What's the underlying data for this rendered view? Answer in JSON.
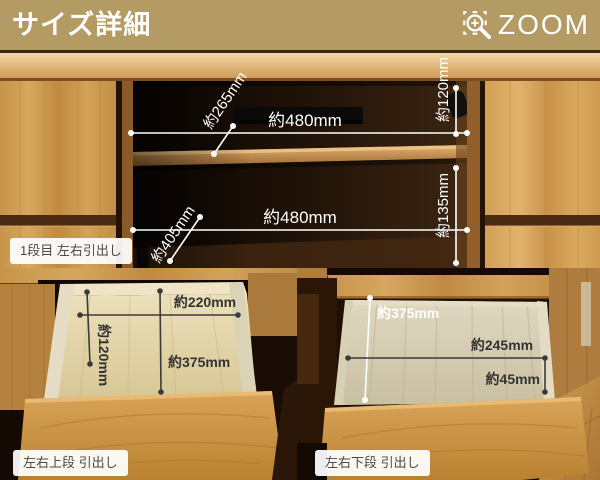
{
  "header": {
    "title": "サイズ詳細",
    "zoom_label": "ZOOM"
  },
  "top_section": {
    "caption": "1段目 左右引出し",
    "upper_shelf": {
      "depth": "約265mm",
      "width": "約480mm",
      "height": "約120mm"
    },
    "lower_shelf": {
      "depth": "約405mm",
      "width": "約480mm",
      "height": "約135mm"
    }
  },
  "drawer_upper": {
    "caption": "左右上段 引出し",
    "width": "約220mm",
    "height": "約120mm",
    "depth": "約375mm"
  },
  "drawer_lower": {
    "caption": "左右下段 引出し",
    "depth": "約375mm",
    "width": "約245mm",
    "height": "約45mm"
  },
  "colors": {
    "header_bg": "#b39b63",
    "header_text": "#ffffff",
    "measure_light": "#ffffff",
    "measure_dark": "#3b3b3b",
    "caption_bg": "#ffffff",
    "caption_text": "#4a4a4a",
    "wood": "#c79449"
  }
}
